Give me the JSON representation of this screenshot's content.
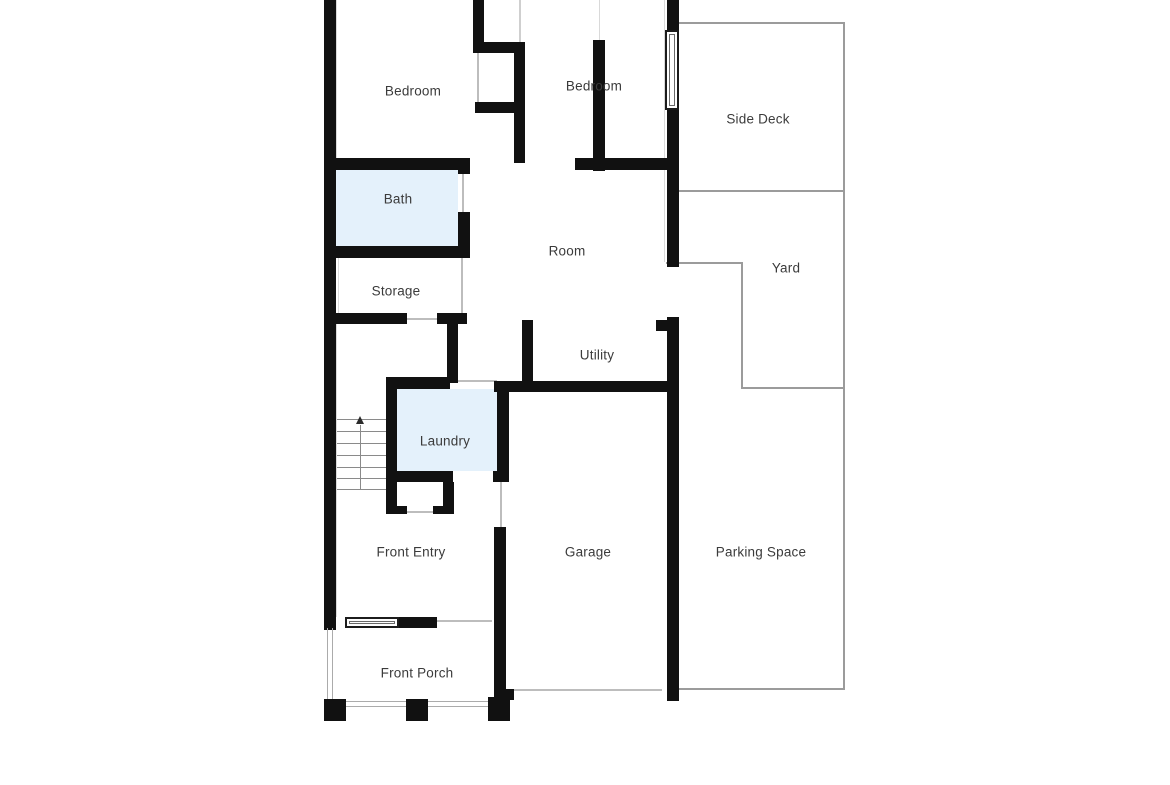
{
  "plan": {
    "type": "floor-plan",
    "stairs_direction": "up"
  },
  "colors": {
    "wall": "#111111",
    "highlight_room_fill": "#e4f1fb",
    "outdoor_boundary": "#9b9b9b",
    "door_opening_line": "#bdbdbd",
    "label_text": "#3b3b3b",
    "background": "#ffffff"
  },
  "rooms": [
    {
      "id": "bedroom-1",
      "label": "Bedroom",
      "highlighted": false
    },
    {
      "id": "bedroom-2",
      "label": "Bedroom",
      "highlighted": false
    },
    {
      "id": "side-deck",
      "label": "Side Deck",
      "highlighted": false
    },
    {
      "id": "bath",
      "label": "Bath",
      "highlighted": true
    },
    {
      "id": "room",
      "label": "Room",
      "highlighted": false
    },
    {
      "id": "yard",
      "label": "Yard",
      "highlighted": false
    },
    {
      "id": "storage",
      "label": "Storage",
      "highlighted": false
    },
    {
      "id": "utility",
      "label": "Utility",
      "highlighted": false
    },
    {
      "id": "laundry",
      "label": "Laundry",
      "highlighted": true
    },
    {
      "id": "front-entry",
      "label": "Front Entry",
      "highlighted": false
    },
    {
      "id": "garage",
      "label": "Garage",
      "highlighted": false
    },
    {
      "id": "parking-space",
      "label": "Parking Space",
      "highlighted": false
    },
    {
      "id": "front-porch",
      "label": "Front Porch",
      "highlighted": false
    }
  ]
}
